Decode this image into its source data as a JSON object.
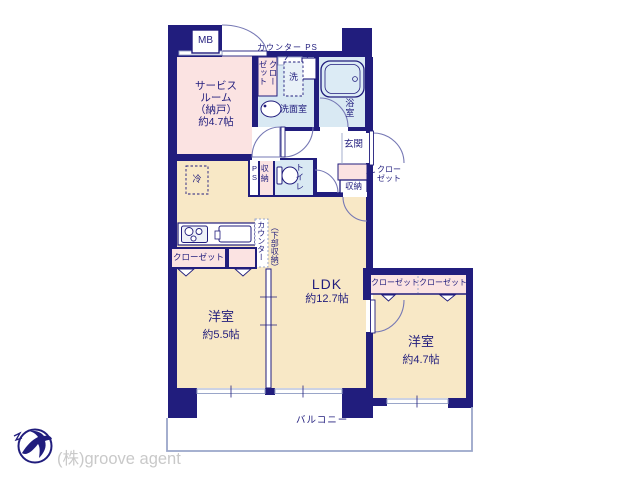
{
  "colors": {
    "wall": "#211d7d",
    "room_cream": "#f8e8c6",
    "room_pink": "#fbe3e2",
    "room_wet_blue": "#d9e9f3",
    "thin_line": "#9aa6c9",
    "logo_text_gray": "#c9c9c9"
  },
  "labels": {
    "mb": "MB",
    "counter_ps": "カウンター PS",
    "closet": "クローゼット",
    "washer": "洗",
    "washroom": "洗面室",
    "bathroom": "浴室",
    "entrance": "玄関",
    "storage": "収納",
    "toilet": "トイレ",
    "ps": "PS",
    "fridge": "冷",
    "counter": "カウンター",
    "under_counter_storage": "（下部収納）",
    "balcony": "バルコニー"
  },
  "rooms": {
    "service_room": {
      "line1": "サービス",
      "line2": "ルーム",
      "line3": "（納戸）",
      "line4": "約4.7帖"
    },
    "ldk": {
      "name": "LDK",
      "size": "約12.7帖"
    },
    "bedroom_55": {
      "name": "洋室",
      "size": "約5.5帖"
    },
    "bedroom_47": {
      "name": "洋室",
      "size": "約4.7帖"
    }
  },
  "footer": {
    "company": "(株)groove agent"
  }
}
